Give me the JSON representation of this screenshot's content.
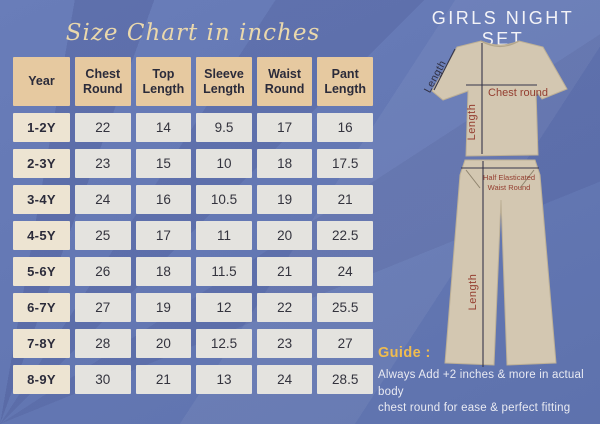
{
  "title": "Size Chart in inches",
  "product_title": "GIRLS NIGHT SET",
  "chart_data": {
    "type": "table",
    "title": "Size Chart in inches",
    "units": "inches",
    "columns": [
      "Year",
      "Chest Round",
      "Top Length",
      "Sleeve Length",
      "Waist Round",
      "Pant Length"
    ],
    "rows": [
      [
        "1-2Y",
        "22",
        "14",
        "9.5",
        "17",
        "16"
      ],
      [
        "2-3Y",
        "23",
        "15",
        "10",
        "18",
        "17.5"
      ],
      [
        "3-4Y",
        "24",
        "16",
        "10.5",
        "19",
        "21"
      ],
      [
        "4-5Y",
        "25",
        "17",
        "11",
        "20",
        "22.5"
      ],
      [
        "5-6Y",
        "26",
        "18",
        "11.5",
        "21",
        "24"
      ],
      [
        "6-7Y",
        "27",
        "19",
        "12",
        "22",
        "25.5"
      ],
      [
        "7-8Y",
        "28",
        "20",
        "12.5",
        "23",
        "27"
      ],
      [
        "8-9Y",
        "30",
        "21",
        "13",
        "24",
        "28.5"
      ]
    ]
  },
  "diagram": {
    "labels": {
      "sleeve_length": "Length",
      "top_length": "Length",
      "chest_round": "Chest round",
      "waist_line1": "Half Elasticated",
      "waist_line2": "Waist Round",
      "pant_length": "Length"
    }
  },
  "guide": {
    "heading": "Guide :",
    "line1": "Always Add +2 inches & more in actual body",
    "line2": "chest round for ease & perfect fitting"
  },
  "colors": {
    "background": "#6478b4",
    "header_cell": "#e6c9a0",
    "year_cell": "#ede4d2",
    "value_cell": "#e4e3df",
    "title_cream": "#ead8ac",
    "guide_gold": "#f0bc4f",
    "label_red": "#943e30",
    "garment_fill": "#d3c7b1"
  }
}
